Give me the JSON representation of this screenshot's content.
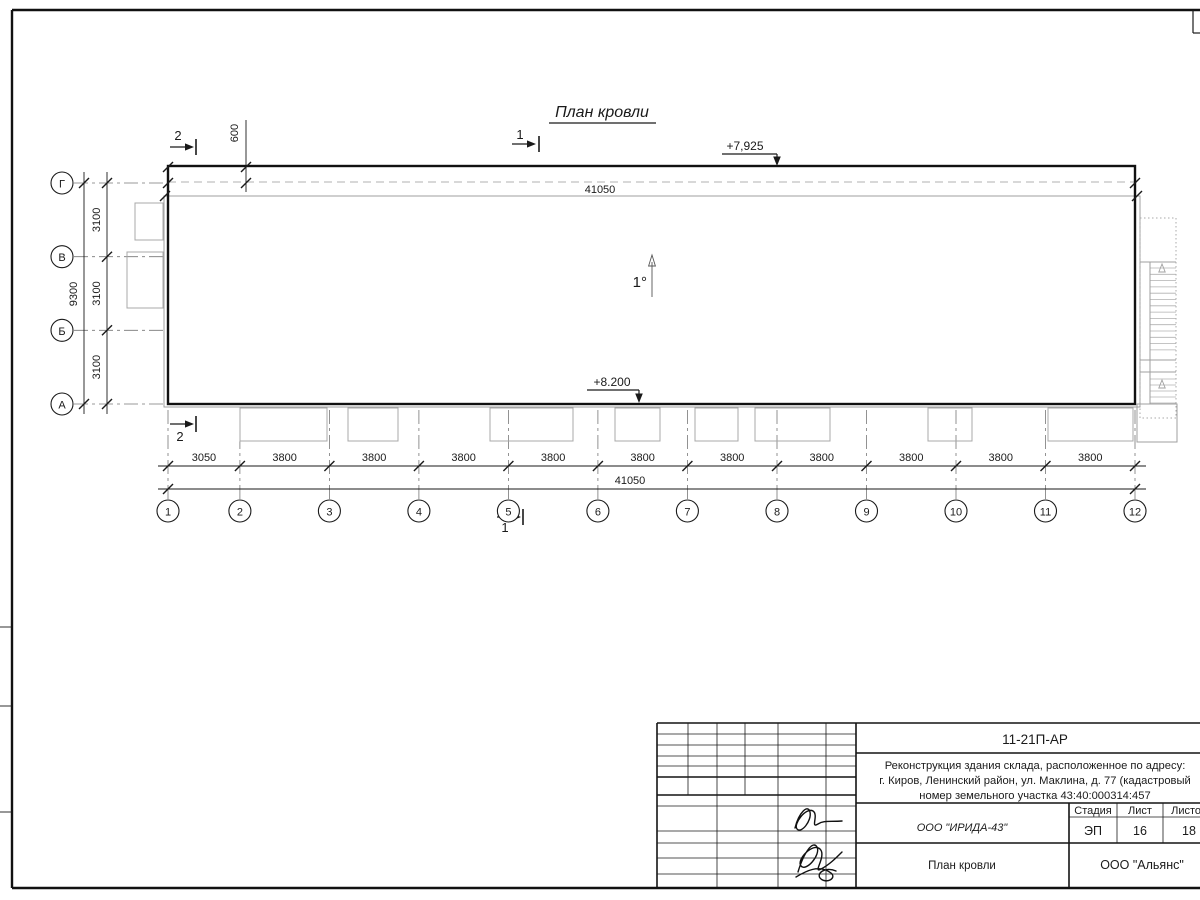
{
  "sheet": {
    "title": "План кровли",
    "slope_label": "1°",
    "elevation_top": "+7,925",
    "elevation_bottom": "+8.200",
    "dim_overhang": "600",
    "dim_total_top": "41050",
    "dim_total_bottom": "41050",
    "section_marks": {
      "s1": "1",
      "s2": "2"
    },
    "grid": {
      "columns": [
        "1",
        "2",
        "3",
        "4",
        "5",
        "6",
        "7",
        "8",
        "9",
        "10",
        "11",
        "12"
      ],
      "rows": [
        "Г",
        "В",
        "Б",
        "А"
      ],
      "bottom_segments": [
        "3050",
        "3800",
        "3800",
        "3800",
        "3800",
        "3800",
        "3800",
        "3800",
        "3800",
        "3800",
        "3800"
      ],
      "left_segments": [
        "3100",
        "3100",
        "3100"
      ],
      "left_total": "9300"
    }
  },
  "title_block": {
    "doc_number": "11-21П-АР",
    "project_lines": [
      "Реконструкция здания склада, расположенное по адресу:",
      "г. Киров, Ленинский район, ул. Маклина, д. 77 (кадастровый",
      "номер земельного участка 43:40:000314:457"
    ],
    "header_cols": [
      "Изм.",
      "Кол.",
      "Лист",
      "№док.",
      "Подп.",
      "Дата"
    ],
    "rows": [
      {
        "role": "Разработал",
        "name": "Шабалина",
        "date": "07.21"
      },
      {
        "role": "Н. контр.",
        "name": "Двоеглазов",
        "date": "07.21"
      },
      {
        "role": "ГИП",
        "name": "Коротаев",
        "date": "07.21"
      }
    ],
    "company": "ООО \"ИРИДА-43\"",
    "stage_label": "Стадия",
    "sheet_label": "Лист",
    "sheets_label": "Листов",
    "stage": "ЭП",
    "sheet_no": "16",
    "sheets_total": "18",
    "drawing_name": "План кровли",
    "contractor": "ООО \"Альянс\""
  }
}
